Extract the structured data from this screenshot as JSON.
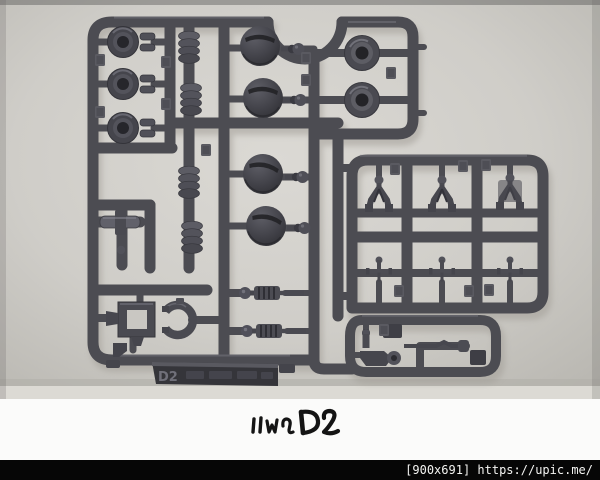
{
  "photo": {
    "subject": "Injection-molded plastic model kit parts runner (sprue) photographed on a light gray background",
    "sprue_label": "D2",
    "plastic_color": "#4c4c52",
    "background_color": "#cfcdc8",
    "part_groups": [
      {
        "name": "cylinder-polycap",
        "count": 3
      },
      {
        "name": "bellows-pipe",
        "count": 4
      },
      {
        "name": "dome-armor",
        "count": 4
      },
      {
        "name": "ball-joint",
        "count": 4
      },
      {
        "name": "round-socket",
        "count": 2
      },
      {
        "name": "wishbone-joint",
        "count": 3
      },
      {
        "name": "pin-joint",
        "count": 3
      },
      {
        "name": "square-frame",
        "count": 1
      },
      {
        "name": "c-ring",
        "count": 1
      },
      {
        "name": "ridged-piston",
        "count": 2
      },
      {
        "name": "small-fittings",
        "count": 6
      }
    ]
  },
  "caption": {
    "text": "แผง D2"
  },
  "watermark": {
    "text": "[900x691] https://upic.me/"
  }
}
